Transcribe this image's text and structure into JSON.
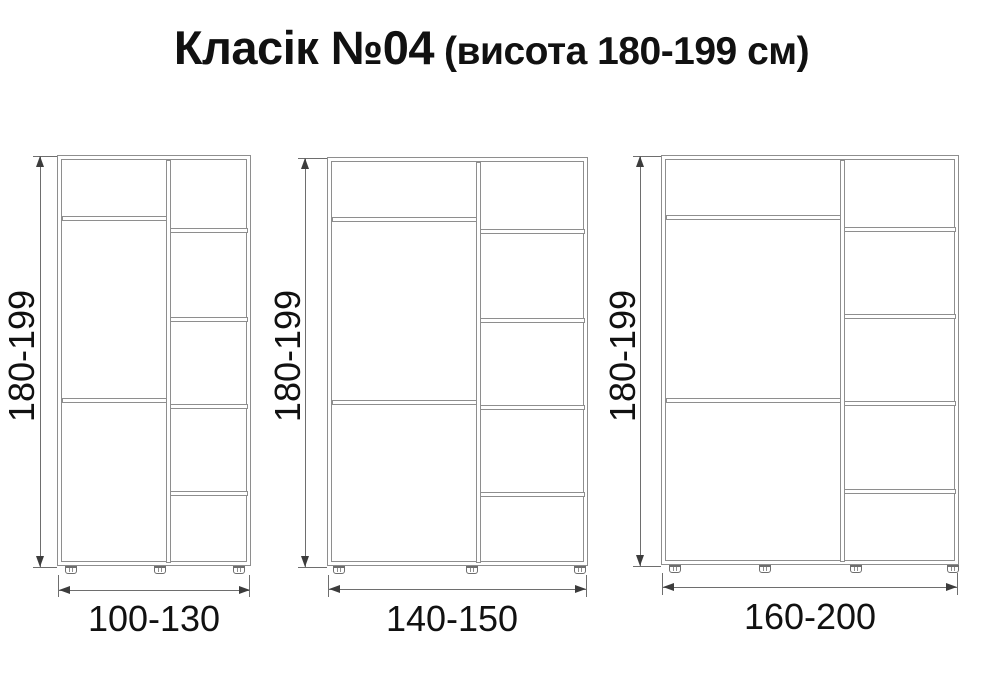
{
  "title": {
    "main": "Класік №04",
    "suffix": "(висота 180-199 см)"
  },
  "cabinets": [
    {
      "height_label": "180-199",
      "width_label": "100-130"
    },
    {
      "height_label": "180-199",
      "width_label": "140-150"
    },
    {
      "height_label": "180-199",
      "width_label": "160-200"
    }
  ],
  "colors": {
    "line": "#8e8e8e",
    "dim": "#6e6e6e",
    "arrow": "#3c3c3c",
    "text": "#111111",
    "bg": "#ffffff"
  }
}
